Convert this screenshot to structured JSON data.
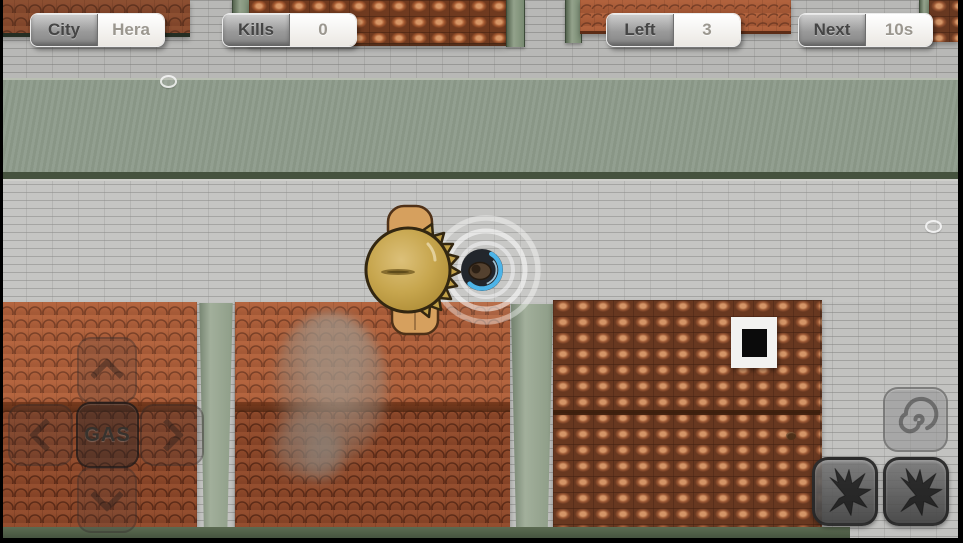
{
  "hud": {
    "stats": [
      {
        "id": "city",
        "label": "City",
        "value": "Hera"
      },
      {
        "id": "kills",
        "label": "Kills",
        "value": "0"
      },
      {
        "id": "left",
        "label": "Left",
        "value": "3"
      },
      {
        "id": "next",
        "label": "Next",
        "value": "10s"
      }
    ]
  },
  "controls": {
    "gas_label": "GAS",
    "dpad_icons": {
      "up": "chevron-up-icon",
      "down": "chevron-down-icon",
      "left": "chevron-left-icon",
      "right": "chevron-right-icon"
    },
    "ability_icons": [
      "spiral-icon",
      "crawler-icon",
      "crawler-icon"
    ]
  },
  "icons": {
    "field_items": "pebble-icon"
  },
  "colors": {
    "roof_toon": "#a3522f",
    "roof_photo": "#9b5734",
    "road_brick": "#c2c2c0",
    "grass": "#8e9b8b",
    "trim_green": "#7d8f7a",
    "portal_blue": "#4db4e8",
    "hat_straw": "#c9a851",
    "hud_label_text": "#454545",
    "hud_value_text": "#9b978f"
  }
}
